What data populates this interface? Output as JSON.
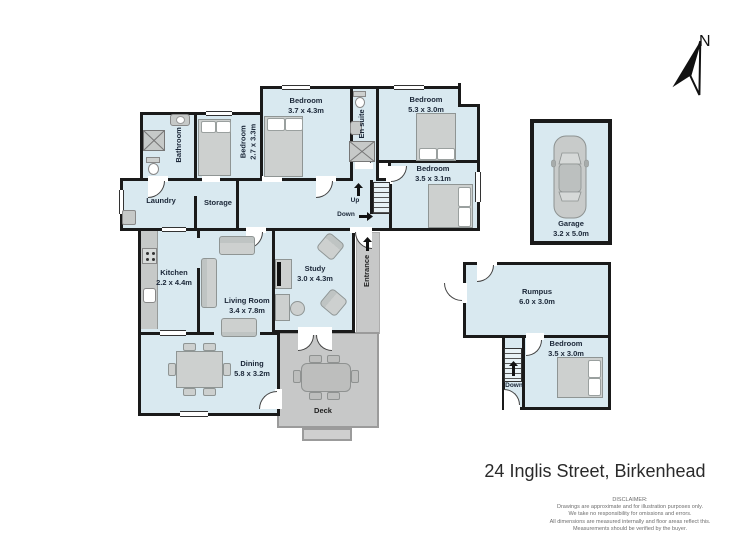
{
  "title": "24 Inglis Street, Birkenhead",
  "compass": {
    "label": "N"
  },
  "navigation": {
    "up": "Up",
    "down": "Down",
    "entrance": "Entrance",
    "down_lower": "Down"
  },
  "rooms": {
    "bathroom": {
      "name": "Bathroom"
    },
    "bedroom_2_7": {
      "name": "Bedroom",
      "dims": "2.7 x 3.3m"
    },
    "bedroom_3_7": {
      "name": "Bedroom",
      "dims": "3.7 x 4.3m"
    },
    "ensuite": {
      "name": "En suite"
    },
    "bedroom_5_3": {
      "name": "Bedroom",
      "dims": "5.3 x 3.0m"
    },
    "bedroom_3_5_3_1": {
      "name": "Bedroom",
      "dims": "3.5 x 3.1m"
    },
    "laundry": {
      "name": "Laundry"
    },
    "storage": {
      "name": "Storage"
    },
    "kitchen": {
      "name": "Kitchen",
      "dims": "2.2 x 4.4m"
    },
    "living": {
      "name": "Living Room",
      "dims": "3.4 x 7.8m"
    },
    "study": {
      "name": "Study",
      "dims": "3.0 x 4.3m"
    },
    "dining": {
      "name": "Dining",
      "dims": "5.8 x 3.2m"
    },
    "deck": {
      "name": "Deck"
    },
    "garage": {
      "name": "Garage",
      "dims": "3.2 x 5.0m"
    },
    "rumpus": {
      "name": "Rumpus",
      "dims": "6.0 x 3.0m"
    },
    "bedroom_3_5_3_0": {
      "name": "Bedroom",
      "dims": "3.5 x 3.0m"
    }
  },
  "disclaimer": {
    "heading": "DISCLAIMER:",
    "lines": [
      "Drawings are approximate and for illustration purposes only.",
      "We take no responsibility for omissions and errors.",
      "All dimensions are measured internally and floor areas reflect this.",
      "Measurements should be verified by the buyer."
    ]
  },
  "colors": {
    "room_fill": "#d9e9f0",
    "wall": "#1a1a1a",
    "outdoor_fill": "#c7c8c8",
    "furniture_fill": "#cdd0cf"
  }
}
